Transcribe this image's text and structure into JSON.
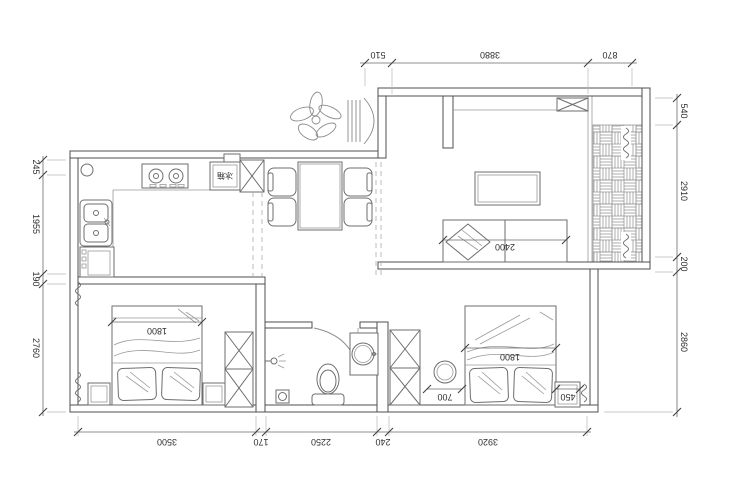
{
  "drawing": {
    "type": "apartment-floor-plan",
    "line_color": "#4f4f4f",
    "furniture_color": "#6e6e6e",
    "hatch_color": "#9a9a9a",
    "background": "#ffffff"
  },
  "dimensions": {
    "top": [
      "510",
      "3880",
      "870"
    ],
    "right": [
      "540",
      "2910",
      "200",
      "2860"
    ],
    "left": [
      "245",
      "1955",
      "190",
      "2760"
    ],
    "bottom": [
      "3500",
      "170",
      "2250",
      "240",
      "3920"
    ]
  },
  "interior": {
    "sofa_width": "2400",
    "left_bed_width": "1800",
    "right_bed_width": "1800",
    "stool_clearance": "700",
    "nightstand_width": "450",
    "fridge_label": "冰箱"
  }
}
